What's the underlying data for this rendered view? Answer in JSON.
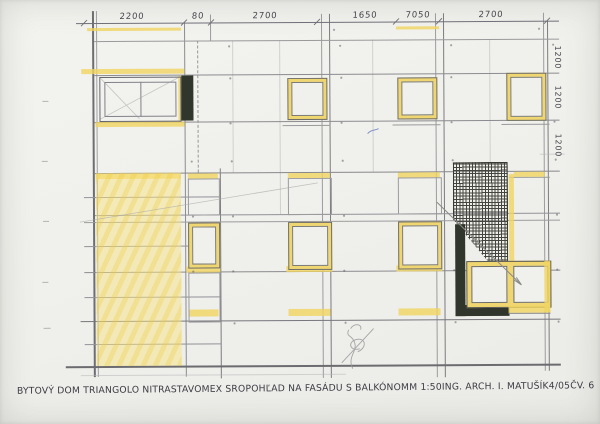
{
  "title_block": {
    "project": "BYTOVÝ DOM TRIANGOLO NITRA",
    "company": "STAVOMEX SRO",
    "subject": "POHĽAD NA FASÁDU S BALKÓNOM",
    "scale": "M 1:50",
    "architect": "ING. ARCH. I. MATUŠÍK",
    "date": "4/05",
    "sheet_no": "ČV. 6"
  },
  "dimensions": {
    "top": [
      "2200",
      "80",
      "2700",
      "1650",
      "7050",
      "2700"
    ],
    "right": [
      "1200",
      "1200",
      "1200"
    ]
  },
  "colors": {
    "paper": "#f0f0ec",
    "highlight_yellow": "#f0d671",
    "ink_line": "#8c8c90",
    "dark_fill": "#30362b",
    "pencil": "#9a9a98",
    "caption_ink": "#3b3b44"
  }
}
